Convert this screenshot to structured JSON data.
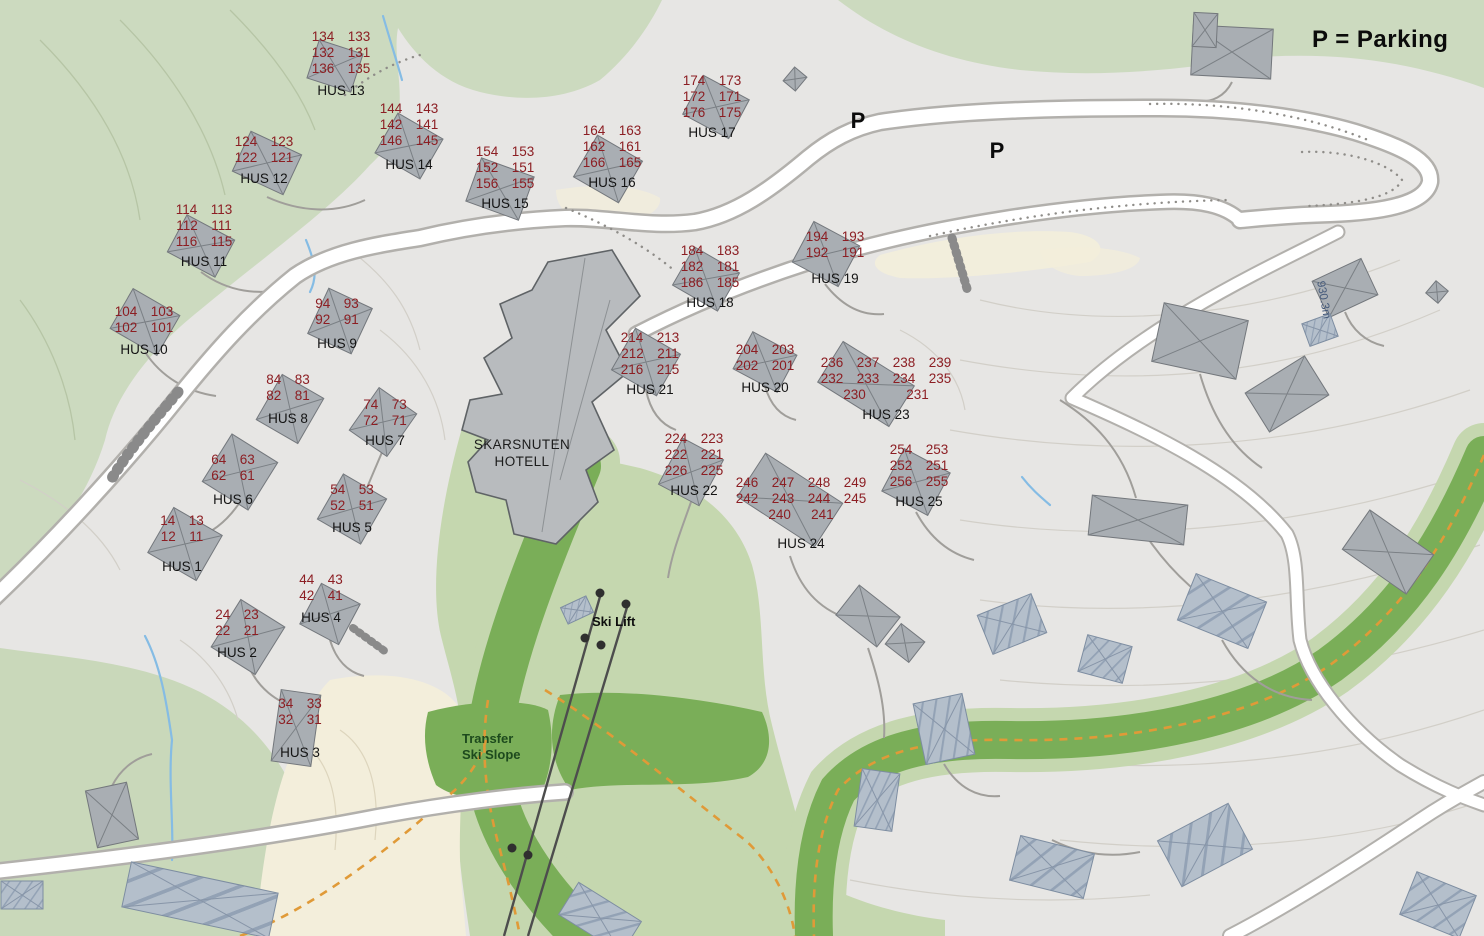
{
  "legend": {
    "text": "P = Parking"
  },
  "map_labels": {
    "hotel": "SKARSNUTEN\nHOTELL",
    "ski_lift": "Ski Lift",
    "transfer_ski_slope": "Transfer\nSki Slope",
    "elevation": "930.3m",
    "parking_symbol": "P"
  },
  "parking_markers": [
    {
      "x": 858,
      "y": 108
    },
    {
      "x": 997,
      "y": 138
    }
  ],
  "houses": [
    {
      "name": "HUS 13",
      "rows": [
        "134  133",
        "132  131",
        "136  135"
      ],
      "x": 341,
      "y": 29,
      "gap": 6
    },
    {
      "name": "HUS 14",
      "rows": [
        "144  143",
        "142  141",
        "146  145"
      ],
      "x": 409,
      "y": 101,
      "gap": 8
    },
    {
      "name": "HUS 12",
      "rows": [
        "124  123",
        "122  121"
      ],
      "x": 264,
      "y": 134,
      "gap": 5
    },
    {
      "name": "HUS 15",
      "rows": [
        "154  153",
        "152  151",
        "156  155"
      ],
      "x": 505,
      "y": 144,
      "gap": 4
    },
    {
      "name": "HUS 16",
      "rows": [
        "164  163",
        "162  161",
        "166  165"
      ],
      "x": 612,
      "y": 123,
      "gap": 4
    },
    {
      "name": "HUS 17",
      "rows": [
        "174  173",
        "172  171",
        "176  175"
      ],
      "x": 712,
      "y": 73,
      "gap": 4
    },
    {
      "name": "HUS 11",
      "rows": [
        "114  113",
        "112  111",
        "116  115"
      ],
      "x": 204,
      "y": 202,
      "gap": 4
    },
    {
      "name": "HUS 10",
      "rows": [
        "104  103",
        "102  101"
      ],
      "x": 144,
      "y": 304,
      "gap": 6
    },
    {
      "name": "HUS 9",
      "rows": [
        "94  93",
        "92  91"
      ],
      "x": 337,
      "y": 296,
      "gap": 8
    },
    {
      "name": "HUS 8",
      "rows": [
        "84  83",
        "82  81"
      ],
      "x": 288,
      "y": 372,
      "gap": 7
    },
    {
      "name": "HUS 7",
      "rows": [
        "74  73",
        "72  71"
      ],
      "x": 385,
      "y": 397,
      "gap": 4
    },
    {
      "name": "HUS 6",
      "rows": [
        "64  63",
        "62  61"
      ],
      "x": 233,
      "y": 452,
      "gap": 8
    },
    {
      "name": "HUS 5",
      "rows": [
        "54  53",
        "52  51"
      ],
      "x": 352,
      "y": 482,
      "gap": 6
    },
    {
      "name": "HUS 1",
      "rows": [
        "14  13",
        "12  11"
      ],
      "x": 182,
      "y": 513,
      "gap": 14
    },
    {
      "name": "HUS 4",
      "rows": [
        "44  43",
        "42  41"
      ],
      "x": 321,
      "y": 572,
      "gap": 6
    },
    {
      "name": "HUS 2",
      "rows": [
        "24  23",
        "22  21"
      ],
      "x": 237,
      "y": 607,
      "gap": 6
    },
    {
      "name": "HUS 3",
      "rows": [
        "34  33",
        "32  31"
      ],
      "x": 300,
      "y": 696,
      "gap": 17
    },
    {
      "name": "HUS 18",
      "rows": [
        "184  183",
        "182  181",
        "186  185"
      ],
      "x": 710,
      "y": 243,
      "gap": 4
    },
    {
      "name": "HUS 19",
      "rows": [
        "194  193",
        "192  191"
      ],
      "x": 835,
      "y": 229,
      "gap": 10
    },
    {
      "name": "HUS 21",
      "rows": [
        "214  213",
        "212  211",
        "216  215"
      ],
      "x": 650,
      "y": 330,
      "gap": 4
    },
    {
      "name": "HUS 20",
      "rows": [
        "204  203",
        "202  201"
      ],
      "x": 765,
      "y": 342,
      "gap": 6
    },
    {
      "name": "HUS 23",
      "rows": [
        "236  237  238  239",
        "232  233  234  235",
        "230      231"
      ],
      "x": 886,
      "y": 355,
      "gap": 4
    },
    {
      "name": "HUS 22",
      "rows": [
        "224  223",
        "222  221",
        "226  225"
      ],
      "x": 694,
      "y": 431,
      "gap": 4
    },
    {
      "name": "HUS 24",
      "rows": [
        "246  247  248  249",
        "242  243  244  245",
        "240   241"
      ],
      "x": 801,
      "y": 475,
      "gap": 13
    },
    {
      "name": "HUS 25",
      "rows": [
        "254  253",
        "252  251",
        "256  255"
      ],
      "x": 919,
      "y": 442,
      "gap": 4
    }
  ],
  "colors": {
    "unit_number": "#8c1e23",
    "house_label": "#141414",
    "transfer_text": "#1d4a1d",
    "slope_green_dark": "#7aae58",
    "slope_green_light": "#c5d7af",
    "forest_green": "#ccdabf",
    "trail_orange": "#e09a38",
    "terrain_gray": "#e7e6e4",
    "beige": "#f3eedb",
    "building_gray": "#a9aeb3",
    "stream_blue": "#85bce4"
  }
}
